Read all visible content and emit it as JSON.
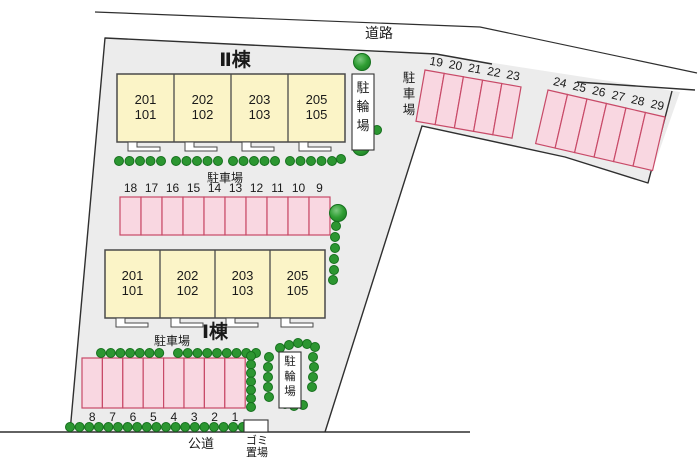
{
  "site": {
    "road_label": "道路",
    "public_road_label": "公道",
    "parking_label": "駐車場",
    "bicycle_label": "駐輪場",
    "garbage_label_line1": "ゴミ",
    "garbage_label_line2": "置場"
  },
  "buildings": [
    {
      "name": "Ⅱ棟",
      "units": [
        [
          "201",
          "101"
        ],
        [
          "202",
          "102"
        ],
        [
          "203",
          "103"
        ],
        [
          "205",
          "105"
        ]
      ]
    },
    {
      "name": "Ⅰ棟",
      "units": [
        [
          "201",
          "101"
        ],
        [
          "202",
          "102"
        ],
        [
          "203",
          "103"
        ],
        [
          "205",
          "105"
        ]
      ]
    }
  ],
  "parking": {
    "middle_row": [
      "18",
      "17",
      "16",
      "15",
      "14",
      "13",
      "12",
      "11",
      "10",
      "9"
    ],
    "bottom_row": [
      "8",
      "7",
      "6",
      "5",
      "4",
      "3",
      "2",
      "1"
    ],
    "right_row_a": [
      "19",
      "20",
      "21",
      "22",
      "23"
    ],
    "right_row_b": [
      "24",
      "25",
      "26",
      "27",
      "28",
      "29"
    ]
  },
  "colors": {
    "site_fill": "#ececec",
    "boundary": "#2f2f2f",
    "building_fill": "#fbf4c7",
    "building_stroke": "#4a4a4a",
    "stall_fill": "#f9d7e1",
    "stall_stroke": "#c84a68",
    "tree_fill": "#2c9631",
    "tree_stroke": "#15701d"
  }
}
